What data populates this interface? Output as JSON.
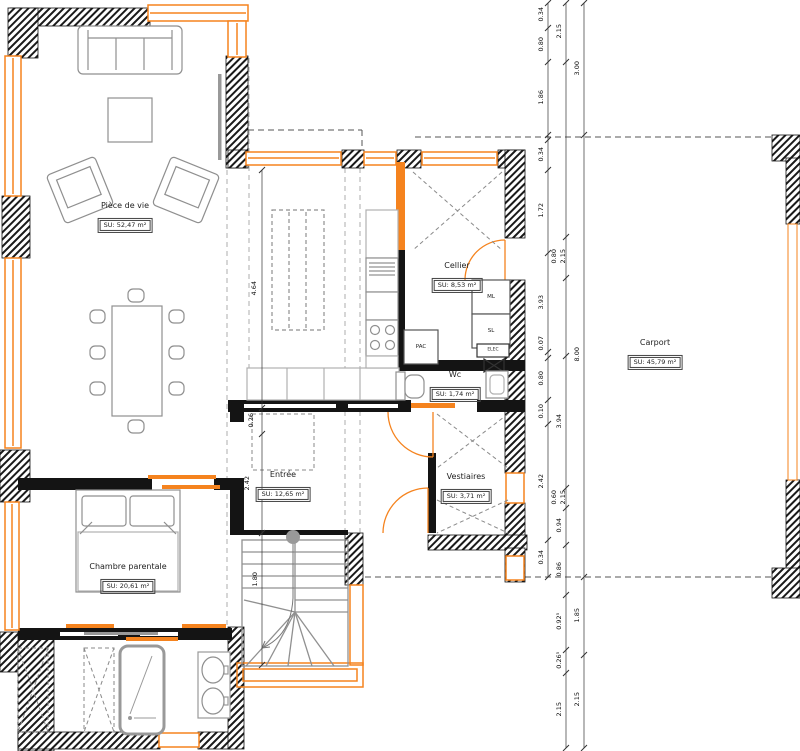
{
  "rooms": {
    "piece_de_vie": {
      "name": "Pièce de vie",
      "area": "SU: 52,47 m²"
    },
    "cellier": {
      "name": "Cellier",
      "area": "SU: 8,53 m²"
    },
    "wc": {
      "name": "Wc",
      "area": "SU: 1,74 m²"
    },
    "entree": {
      "name": "Entrée",
      "area": "SU: 12,65 m²"
    },
    "vestiaires": {
      "name": "Vestiaires",
      "area": "SU: 3,71 m²"
    },
    "chambre_parentale": {
      "name": "Chambre parentale",
      "area": "SU: 20,61 m²"
    },
    "carport": {
      "name": "Carport",
      "area": "SU: 45,79 m²"
    }
  },
  "appliances": {
    "pac": "PAC",
    "ml": "ML",
    "sl": "SL",
    "elec": "ELEC"
  },
  "dims": {
    "inner": [
      "0.34",
      "0.80",
      "1.86",
      "0.34",
      "1.72",
      "3.93",
      "0.07",
      "0.80",
      "0.10",
      "2.42",
      "0.34"
    ],
    "middle": [
      "2.15",
      "0.80",
      "2.15",
      "3.94",
      "0.60",
      "2.15",
      "0.94",
      "0.86",
      "0.92⁵",
      "0.26⁵",
      "2.15"
    ],
    "outer": [
      "3.00",
      "8.00",
      "1.85",
      "2.15"
    ],
    "interior": [
      "4.64",
      "0.26",
      "2.42",
      "1.80"
    ]
  },
  "colors": {
    "wall": "#1a1a1a",
    "joinery": "#f5831e",
    "furniture": "#8f8f8f"
  }
}
